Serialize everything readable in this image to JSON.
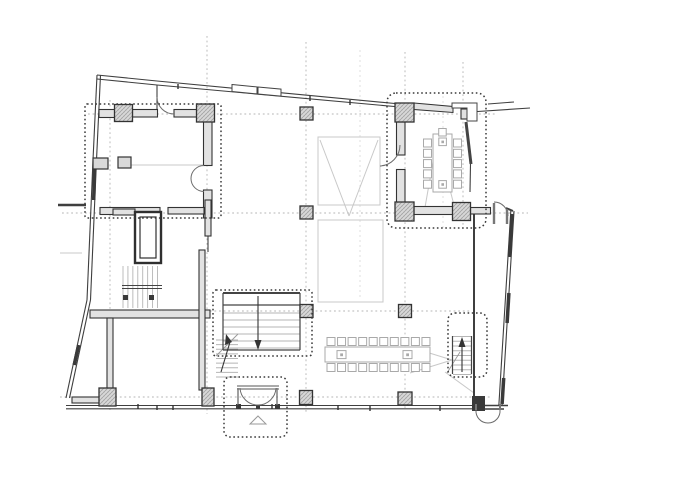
{
  "canvas": {
    "w": 688,
    "h": 486,
    "bg": "#ffffff"
  },
  "colors": {
    "wall_dark": "#3a3a3a",
    "wall_line": "#3f3f3f",
    "wall_fill": "#e2e2e2",
    "column_edge": "#333333",
    "column_hatch": "#9b9b9b",
    "column_fill": "#d8d8d8",
    "grid_dash": "#b4b4b4",
    "grid_light": "#d8d8d8",
    "overhead_gray": "#c8c8c8",
    "furniture_gray": "#a9a9a9",
    "stair_tread": "#b5b5b5",
    "door_arc": "#6b6b6b",
    "dotted_outline": "#3a3a3a"
  },
  "legend": {
    "dotted_rectangles": "room zone outlines (library, meeting room, main stair, side stair, entrance vestibule)",
    "hatched_squares": "structural columns on grid",
    "arrows": "stair direction arrows",
    "arcs": "door swings"
  },
  "layers": [
    {
      "name": "grid-lines",
      "iname": "grid-line",
      "type": "line",
      "s": {
        "st": "#b4b4b4",
        "sw": 0.9,
        "da": "1.8 2.8"
      },
      "items": [
        [
          110,
          100,
          110,
          410
        ],
        [
          207,
          36,
          207,
          414
        ],
        [
          306,
          42,
          306,
          414
        ],
        [
          405,
          52,
          405,
          410
        ],
        [
          463,
          62,
          463,
          228
        ],
        [
          88,
          114,
          497,
          114
        ],
        [
          62,
          213,
          528,
          213
        ],
        [
          196,
          311,
          470,
          311
        ],
        [
          60,
          397,
          490,
          397
        ]
      ]
    },
    {
      "name": "grid-lines-light",
      "iname": "grid-line-light",
      "type": "line",
      "s": {
        "st": "#d8d8d8",
        "sw": 0.8,
        "da": "2 3"
      },
      "items": [
        [
          443,
          96,
          443,
          228
        ],
        [
          360,
          50,
          360,
          300
        ]
      ]
    },
    {
      "name": "overhead-lines",
      "iname": "overhead-line",
      "type": "line",
      "s": {
        "st": "#c8c8c8",
        "sw": 1
      },
      "items": [
        [
          320,
          140,
          349,
          216
        ],
        [
          378,
          140,
          349,
          216
        ],
        [
          437,
          139,
          424,
          213
        ],
        [
          437,
          139,
          456,
          213
        ],
        [
          429,
          167,
          450,
          167
        ],
        [
          410,
          373,
          452,
          360
        ],
        [
          410,
          347,
          452,
          360
        ],
        [
          445,
          372,
          474,
          393
        ],
        [
          130,
          165,
          203,
          165
        ],
        [
          60,
          253,
          82,
          253
        ]
      ]
    },
    {
      "name": "overhead-voids",
      "iname": "overhead-void-rect",
      "type": "rect",
      "s": {
        "st": "#c8c8c8",
        "sw": 1,
        "f": "none"
      },
      "items": [
        [
          318,
          137,
          62,
          68
        ],
        [
          318,
          220,
          65,
          82
        ]
      ]
    },
    {
      "name": "tables",
      "iname": "table",
      "type": "rect",
      "s": {
        "st": "#a9a9a9",
        "sw": 1,
        "f": "#ffffff"
      },
      "items": [
        [
          433,
          134,
          19,
          58
        ],
        [
          438.8,
          138,
          7.6,
          7.6
        ],
        [
          438.8,
          180.6,
          7.6,
          7.6
        ],
        [
          325,
          347,
          105,
          15
        ],
        [
          337,
          350.6,
          9,
          8
        ],
        [
          403,
          350.6,
          9,
          8
        ]
      ]
    },
    {
      "name": "table-dots",
      "iname": "table-dot",
      "type": "rect",
      "s": {
        "st": "none",
        "sw": 0,
        "f": "#a9a9a9"
      },
      "items": [
        [
          441.4,
          140.6,
          2.6,
          2.6
        ],
        [
          441.4,
          183.2,
          2.6,
          2.6
        ],
        [
          340.2,
          353.4,
          2.8,
          2.8
        ],
        [
          406.2,
          353.4,
          2.8,
          2.8
        ]
      ]
    },
    {
      "name": "chairs",
      "iname": "chair-row",
      "type": "chairs",
      "s": {
        "st": "#a9a9a9",
        "sw": 1,
        "f": "#ffffff"
      },
      "items": [
        [
          423.5,
          139,
          5,
          0,
          10.3,
          8
        ],
        [
          453.5,
          139,
          5,
          0,
          10.3,
          8
        ],
        [
          438.7,
          128.5,
          1,
          0,
          0,
          7.5
        ],
        [
          327,
          337.5,
          10,
          10.55,
          0,
          8
        ],
        [
          327,
          363.5,
          10,
          10.55,
          0,
          8
        ]
      ]
    },
    {
      "name": "stair-treads",
      "iname": "stair-tread-group",
      "type": "treads",
      "s": {
        "st": "#b5b5b5",
        "sw": 0.9
      },
      "items": [
        [
          223,
          313,
          77,
          35,
          6,
          "h"
        ],
        [
          216,
          340,
          22,
          37,
          9,
          "h"
        ],
        [
          453,
          336.5,
          18.5,
          38,
          9,
          "h"
        ],
        [
          123,
          266,
          34.5,
          42,
          8,
          "v"
        ]
      ]
    },
    {
      "name": "stair-break-lines",
      "iname": "stair-break-line",
      "type": "line",
      "s": {
        "st": "#999999",
        "sw": 0.9
      },
      "items": [
        [
          216,
          356,
          238,
          334
        ],
        [
          447,
          373,
          460,
          352
        ]
      ]
    },
    {
      "name": "envelope-walls",
      "iname": "envelope-wall-line",
      "type": "line",
      "s": {
        "st": "#3f3f3f",
        "sw": 1.1
      },
      "items": [
        [
          97,
          75,
          93,
          160
        ],
        [
          93,
          160,
          87,
          300
        ],
        [
          87,
          300,
          66,
          398
        ],
        [
          100.5,
          75,
          96.5,
          160
        ],
        [
          96.5,
          160,
          90.5,
          300
        ],
        [
          90.5,
          300,
          69.5,
          398
        ],
        [
          97,
          75,
          157,
          81
        ],
        [
          97,
          79,
          157,
          85
        ],
        [
          157,
          81,
          400,
          104
        ],
        [
          157,
          85,
          400,
          107
        ],
        [
          157,
          85,
          157,
          112
        ],
        [
          470,
          112,
          530,
          108
        ],
        [
          488,
          104,
          514,
          102
        ],
        [
          66,
          405.5,
          474,
          405.5
        ],
        [
          66,
          408.8,
          474,
          408.8
        ],
        [
          474,
          405.5,
          508,
          405.5,
          1.4
        ],
        [
          474,
          409,
          504,
          409,
          1.4
        ],
        [
          514,
          211,
          502,
          406
        ],
        [
          510.8,
          211,
          498.8,
          406
        ],
        [
          474,
          212,
          474,
          399,
          2
        ],
        [
          464,
          211,
          474,
          211
        ],
        [
          506,
          208,
          513,
          211,
          2
        ],
        [
          208,
          236,
          208,
          252
        ],
        [
          470.5,
          164,
          470,
          192
        ],
        [
          58,
          205,
          86,
          205,
          2.5
        ]
      ]
    },
    {
      "name": "facade-bands",
      "iname": "facade-band",
      "type": "line",
      "s": {
        "st": "#3a3a3a",
        "sw": 3.5
      },
      "items": [
        [
          94.6,
          165,
          93.7,
          200
        ],
        [
          78.7,
          345,
          74.2,
          365
        ],
        [
          512.1,
          214,
          509.5,
          257
        ],
        [
          508.9,
          293,
          507.1,
          323
        ],
        [
          503.7,
          378,
          502.1,
          404
        ]
      ]
    },
    {
      "name": "interior-walls",
      "iname": "interior-wall",
      "type": "rect",
      "s": {
        "st": "#333333",
        "sw": 1.1,
        "f": "#e2e2e2"
      },
      "items": [
        [
          99,
          109.5,
          16,
          8
        ],
        [
          132.5,
          109.5,
          25,
          7.5
        ],
        [
          174,
          109.5,
          23,
          7.5
        ],
        [
          203.5,
          121.5,
          8.5,
          44
        ],
        [
          203.5,
          190,
          8.5,
          28
        ],
        [
          100,
          207.5,
          60,
          7
        ],
        [
          168,
          207.5,
          36,
          6.5
        ],
        [
          396.5,
          122,
          8.5,
          33
        ],
        [
          396.5,
          169.5,
          8.5,
          33
        ],
        [
          414,
          206.5,
          39,
          8
        ],
        [
          470.5,
          207.5,
          20,
          6.5
        ],
        [
          90,
          310,
          120,
          8
        ],
        [
          107,
          318,
          6,
          72
        ],
        [
          72,
          397,
          30,
          6
        ],
        [
          205,
          200,
          6,
          36
        ],
        [
          199,
          250,
          6,
          140
        ],
        [
          113,
          209,
          22,
          6
        ],
        [
          461,
          109,
          13,
          10
        ]
      ]
    },
    {
      "name": "wall-polygons",
      "iname": "wall-polygon",
      "type": "poly",
      "s": {
        "st": "#333333",
        "sw": 1,
        "f": "#e2e2e2"
      },
      "items": [
        "414,103 453,106.5 453,112.5 414,109.5"
      ]
    },
    {
      "name": "facade-windows",
      "iname": "facade-window",
      "type": "poly",
      "s": {
        "st": "#444444",
        "sw": 1,
        "f": "#ffffff"
      },
      "items": [
        "232,84.5 257,86.9 257,93.9 232,91.5",
        "258,87 281,89.1 281,96.1 258,94",
        "452,103 477,103 477,121 467,121 467,108 452,108"
      ]
    },
    {
      "name": "fixtures",
      "iname": "fixture",
      "type": "rect",
      "s": {
        "st": "#333333",
        "sw": 1.2,
        "f": "#d9d9d9"
      },
      "items": [
        [
          118,
          157,
          13,
          11
        ],
        [
          93,
          158,
          15,
          11
        ]
      ]
    },
    {
      "name": "elevator-shaft",
      "iname": "elevator",
      "type": "rect",
      "s": {
        "st": "#2f2f2f",
        "sw": 2.4,
        "f": "#ffffff"
      },
      "items": [
        [
          135,
          212,
          26,
          51
        ],
        [
          140,
          217,
          16,
          41,
          0,
          1.2
        ]
      ]
    },
    {
      "name": "stair-edges",
      "iname": "stair-edge",
      "type": "line",
      "s": {
        "st": "#444444",
        "sw": 1.2
      },
      "items": [
        [
          223,
          293,
          300,
          293,
          2
        ],
        [
          223,
          293,
          223,
          350
        ],
        [
          300,
          293,
          300,
          350
        ],
        [
          223,
          350,
          300,
          350
        ],
        [
          223,
          305,
          300,
          305
        ],
        [
          122,
          285.5,
          162,
          285.5,
          0.9
        ],
        [
          122,
          288.5,
          162,
          288.5,
          0.9
        ],
        [
          452.5,
          336,
          452.5,
          374
        ],
        [
          471.5,
          336,
          471.5,
          374
        ],
        [
          466,
          122,
          471,
          164,
          3
        ]
      ]
    },
    {
      "name": "stair-arrows",
      "iname": "stair-arrow",
      "type": "line",
      "s": {
        "st": "#333333",
        "sw": 1.1
      },
      "items": [
        [
          258,
          296,
          258,
          345
        ],
        [
          221,
          372,
          230,
          342
        ],
        [
          462,
          372,
          462,
          344
        ]
      ]
    },
    {
      "name": "stair-arrow-heads",
      "iname": "stair-arrow-head",
      "type": "poly",
      "s": {
        "st": "none",
        "sw": 0,
        "f": "#333333"
      },
      "items": [
        "254.5,340 261.5,340 258,350",
        "225,345 232,342 226,334",
        "458.5,347 465.5,347 462,337"
      ]
    },
    {
      "name": "columns",
      "iname": "column",
      "type": "rect",
      "s": {
        "st": "#333333",
        "sw": 1.3,
        "f": "url(#hatch)"
      },
      "items": [
        [
          300,
          107,
          13,
          13
        ],
        [
          300,
          206,
          13,
          13
        ],
        [
          300,
          304.5,
          13,
          13
        ],
        [
          299.5,
          390.5,
          13,
          14
        ],
        [
          398.5,
          304.5,
          13,
          13
        ],
        [
          398,
          392,
          14,
          13
        ],
        [
          99,
          388,
          17,
          18
        ],
        [
          202,
          388,
          12,
          18
        ],
        [
          114.5,
          104.5,
          18,
          17
        ],
        [
          196.5,
          104,
          18,
          18
        ],
        [
          395,
          103,
          19,
          19
        ],
        [
          395,
          202,
          19,
          19
        ],
        [
          452.5,
          202.5,
          18,
          18
        ]
      ]
    },
    {
      "name": "solid-blocks",
      "iname": "solid-block",
      "type": "rect",
      "s": {
        "st": "none",
        "sw": 0,
        "f": "#3a3a3a"
      },
      "items": [
        [
          472,
          396,
          13,
          15
        ],
        [
          236,
          404,
          5,
          5
        ],
        [
          275,
          404,
          5,
          5
        ],
        [
          256,
          405,
          4,
          4
        ],
        [
          123,
          295,
          5,
          5
        ],
        [
          149,
          295,
          5,
          5
        ]
      ]
    },
    {
      "name": "door-arcs",
      "iname": "door-arc",
      "type": "path",
      "s": {
        "st": "#6b6b6b",
        "sw": 1,
        "f": "none"
      },
      "items": [
        "M 204,165.5 A 13,13 0 0 0 204,191.5",
        "M 157,97 A 17,17 0 0 0 174,114",
        "M 400,145 A 21,21 0 0 1 380,166",
        "M 494,202 A 14,14 0 0 1 508,216",
        "M 240,388 A 18,18 0 0 0 258,405",
        "M 276,388 A 18,18 0 0 1 258,405",
        "M 476,410 A 12,12 0 0 0 488,423",
        "M 500,410 A 12,12 0 0 1 488,423"
      ]
    },
    {
      "name": "door-jambs",
      "iname": "door-jamb",
      "type": "line",
      "s": {
        "st": "#777777",
        "sw": 1.2
      },
      "items": [
        [
          238,
          388,
          238,
          405,
          1.4
        ],
        [
          277,
          388,
          277,
          405,
          1.4
        ],
        [
          237,
          386,
          279,
          386
        ],
        [
          237,
          389,
          279,
          389
        ],
        [
          494,
          203,
          494,
          224,
          2.4
        ],
        [
          507,
          209,
          507,
          224,
          2.4
        ],
        [
          476,
          404,
          476,
          410,
          2
        ],
        [
          500,
          404,
          500,
          410,
          2
        ]
      ]
    },
    {
      "name": "entrance-marker",
      "iname": "entrance-triangle",
      "type": "poly",
      "s": {
        "st": "#999999",
        "sw": 1,
        "f": "none"
      },
      "items": [
        "258,416 266,424 250,424"
      ]
    },
    {
      "name": "room-outlines",
      "iname": "room-outline",
      "type": "rect",
      "s": {
        "st": "#3a3a3a",
        "sw": 1.5,
        "da": "1.6 2.6",
        "f": "none"
      },
      "items": [
        [
          85,
          104,
          136,
          114,
          2
        ],
        [
          387,
          93,
          99,
          135,
          9
        ],
        [
          213,
          290,
          99,
          66,
          3
        ],
        [
          448,
          313,
          39,
          64,
          7
        ],
        [
          224,
          377,
          63,
          60,
          6
        ]
      ]
    },
    {
      "name": "mullion-ticks",
      "iname": "mullion-tick",
      "type": "line",
      "s": {
        "st": "#333333",
        "sw": 1.4
      },
      "items": [
        [
          138,
          404,
          138,
          409
        ],
        [
          157,
          405,
          157,
          410
        ],
        [
          173,
          405,
          173,
          410
        ],
        [
          239,
          404,
          239,
          409
        ],
        [
          272,
          404,
          272,
          409
        ],
        [
          338,
          405,
          338,
          410
        ],
        [
          370,
          406,
          370,
          411
        ],
        [
          440,
          406,
          440,
          411
        ],
        [
          178,
          84,
          178,
          89
        ],
        [
          310,
          96,
          310,
          101
        ],
        [
          350,
          100,
          350,
          105
        ]
      ]
    }
  ]
}
